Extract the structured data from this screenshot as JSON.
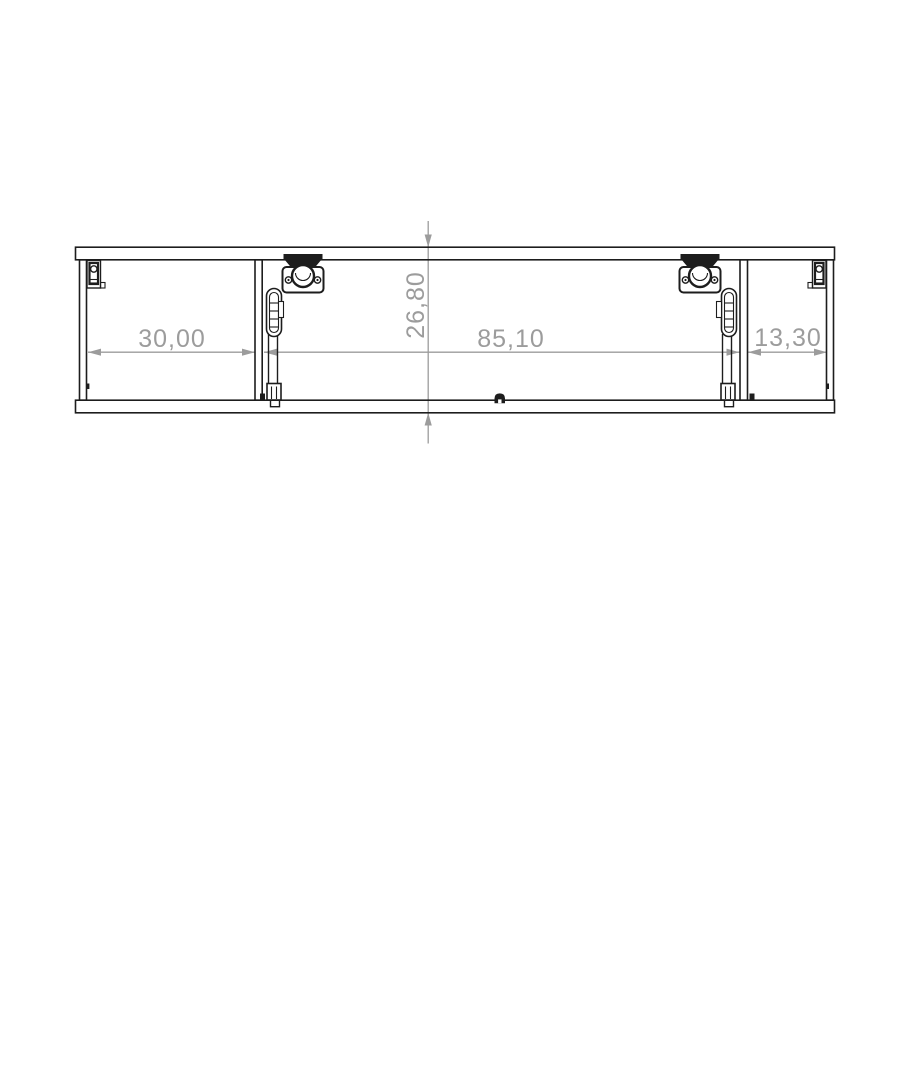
{
  "drawing": {
    "dimensions": {
      "left_width": "30,00",
      "center_width": "85,10",
      "right_width": "13,30",
      "height": "26,80"
    },
    "colors": {
      "outline": "#1d1d1d",
      "dimension_gray": "#9c9c9c",
      "background": "#ffffff"
    }
  }
}
